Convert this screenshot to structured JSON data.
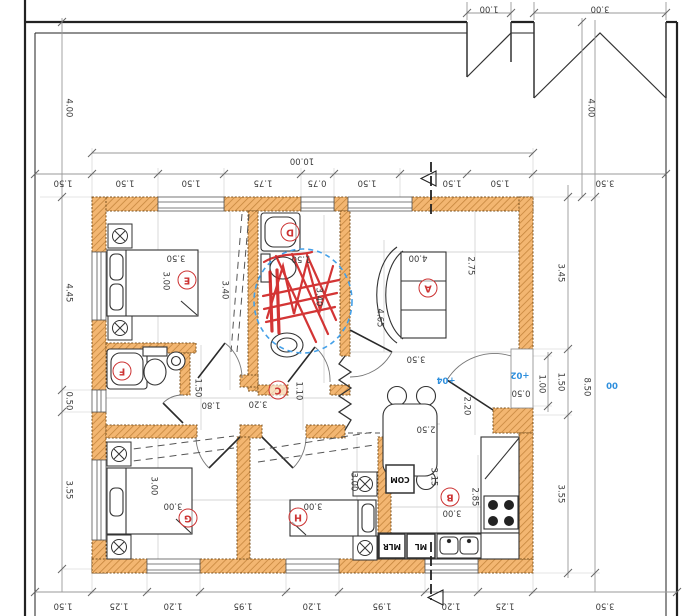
{
  "site": {
    "gate_small": "1.00",
    "gate_large": "3.00",
    "setback_left": "4.00",
    "setback_right": "4.00",
    "level": "00"
  },
  "overall": {
    "width": "10.00",
    "height": "8.50"
  },
  "top_chain": [
    "1.50",
    "1.50",
    "1.50",
    "1.75",
    "0.75",
    "1.50",
    "1.50",
    "1.50",
    "3.50"
  ],
  "bottom_chain": [
    "1.50",
    "1.25",
    "1.20",
    "1.95",
    "1.20",
    "1.95",
    "1.20",
    "1.25",
    "3.50"
  ],
  "left_chain": [
    "4.45",
    "0.50",
    "3.55"
  ],
  "right_chain": [
    "3.45",
    "1.50",
    "1.00",
    "3.55"
  ],
  "rooms": {
    "A": {
      "label": "A",
      "width": "4.00",
      "depth": "2.75",
      "sofa": "4.65",
      "width2": "3.50"
    },
    "B": {
      "label": "B",
      "depth": "3.15",
      "depth2": "2.85",
      "width": "3.00",
      "table": "2.50"
    },
    "C": {
      "label": "C",
      "width": "3.20",
      "depth": "1.10",
      "wc_width": "1.80",
      "wc_depth": "1.50"
    },
    "D": {
      "label": "D",
      "width": "1.50",
      "depth": "3.40"
    },
    "E": {
      "label": "E",
      "width": "3.50",
      "depth": "3.00",
      "closet": "3.40"
    },
    "F": {
      "label": "F"
    },
    "G": {
      "label": "G",
      "width": "3.00",
      "depth": "3.00"
    },
    "H": {
      "label": "H",
      "width": "3.00",
      "depth": "3.00"
    }
  },
  "entry": {
    "door_width": "2.20",
    "step_depth": "0.50",
    "level_outside": "+02",
    "level_inside": "+04"
  },
  "appliances": {
    "com": "COM",
    "ml": "ML",
    "mlr": "MLR"
  }
}
